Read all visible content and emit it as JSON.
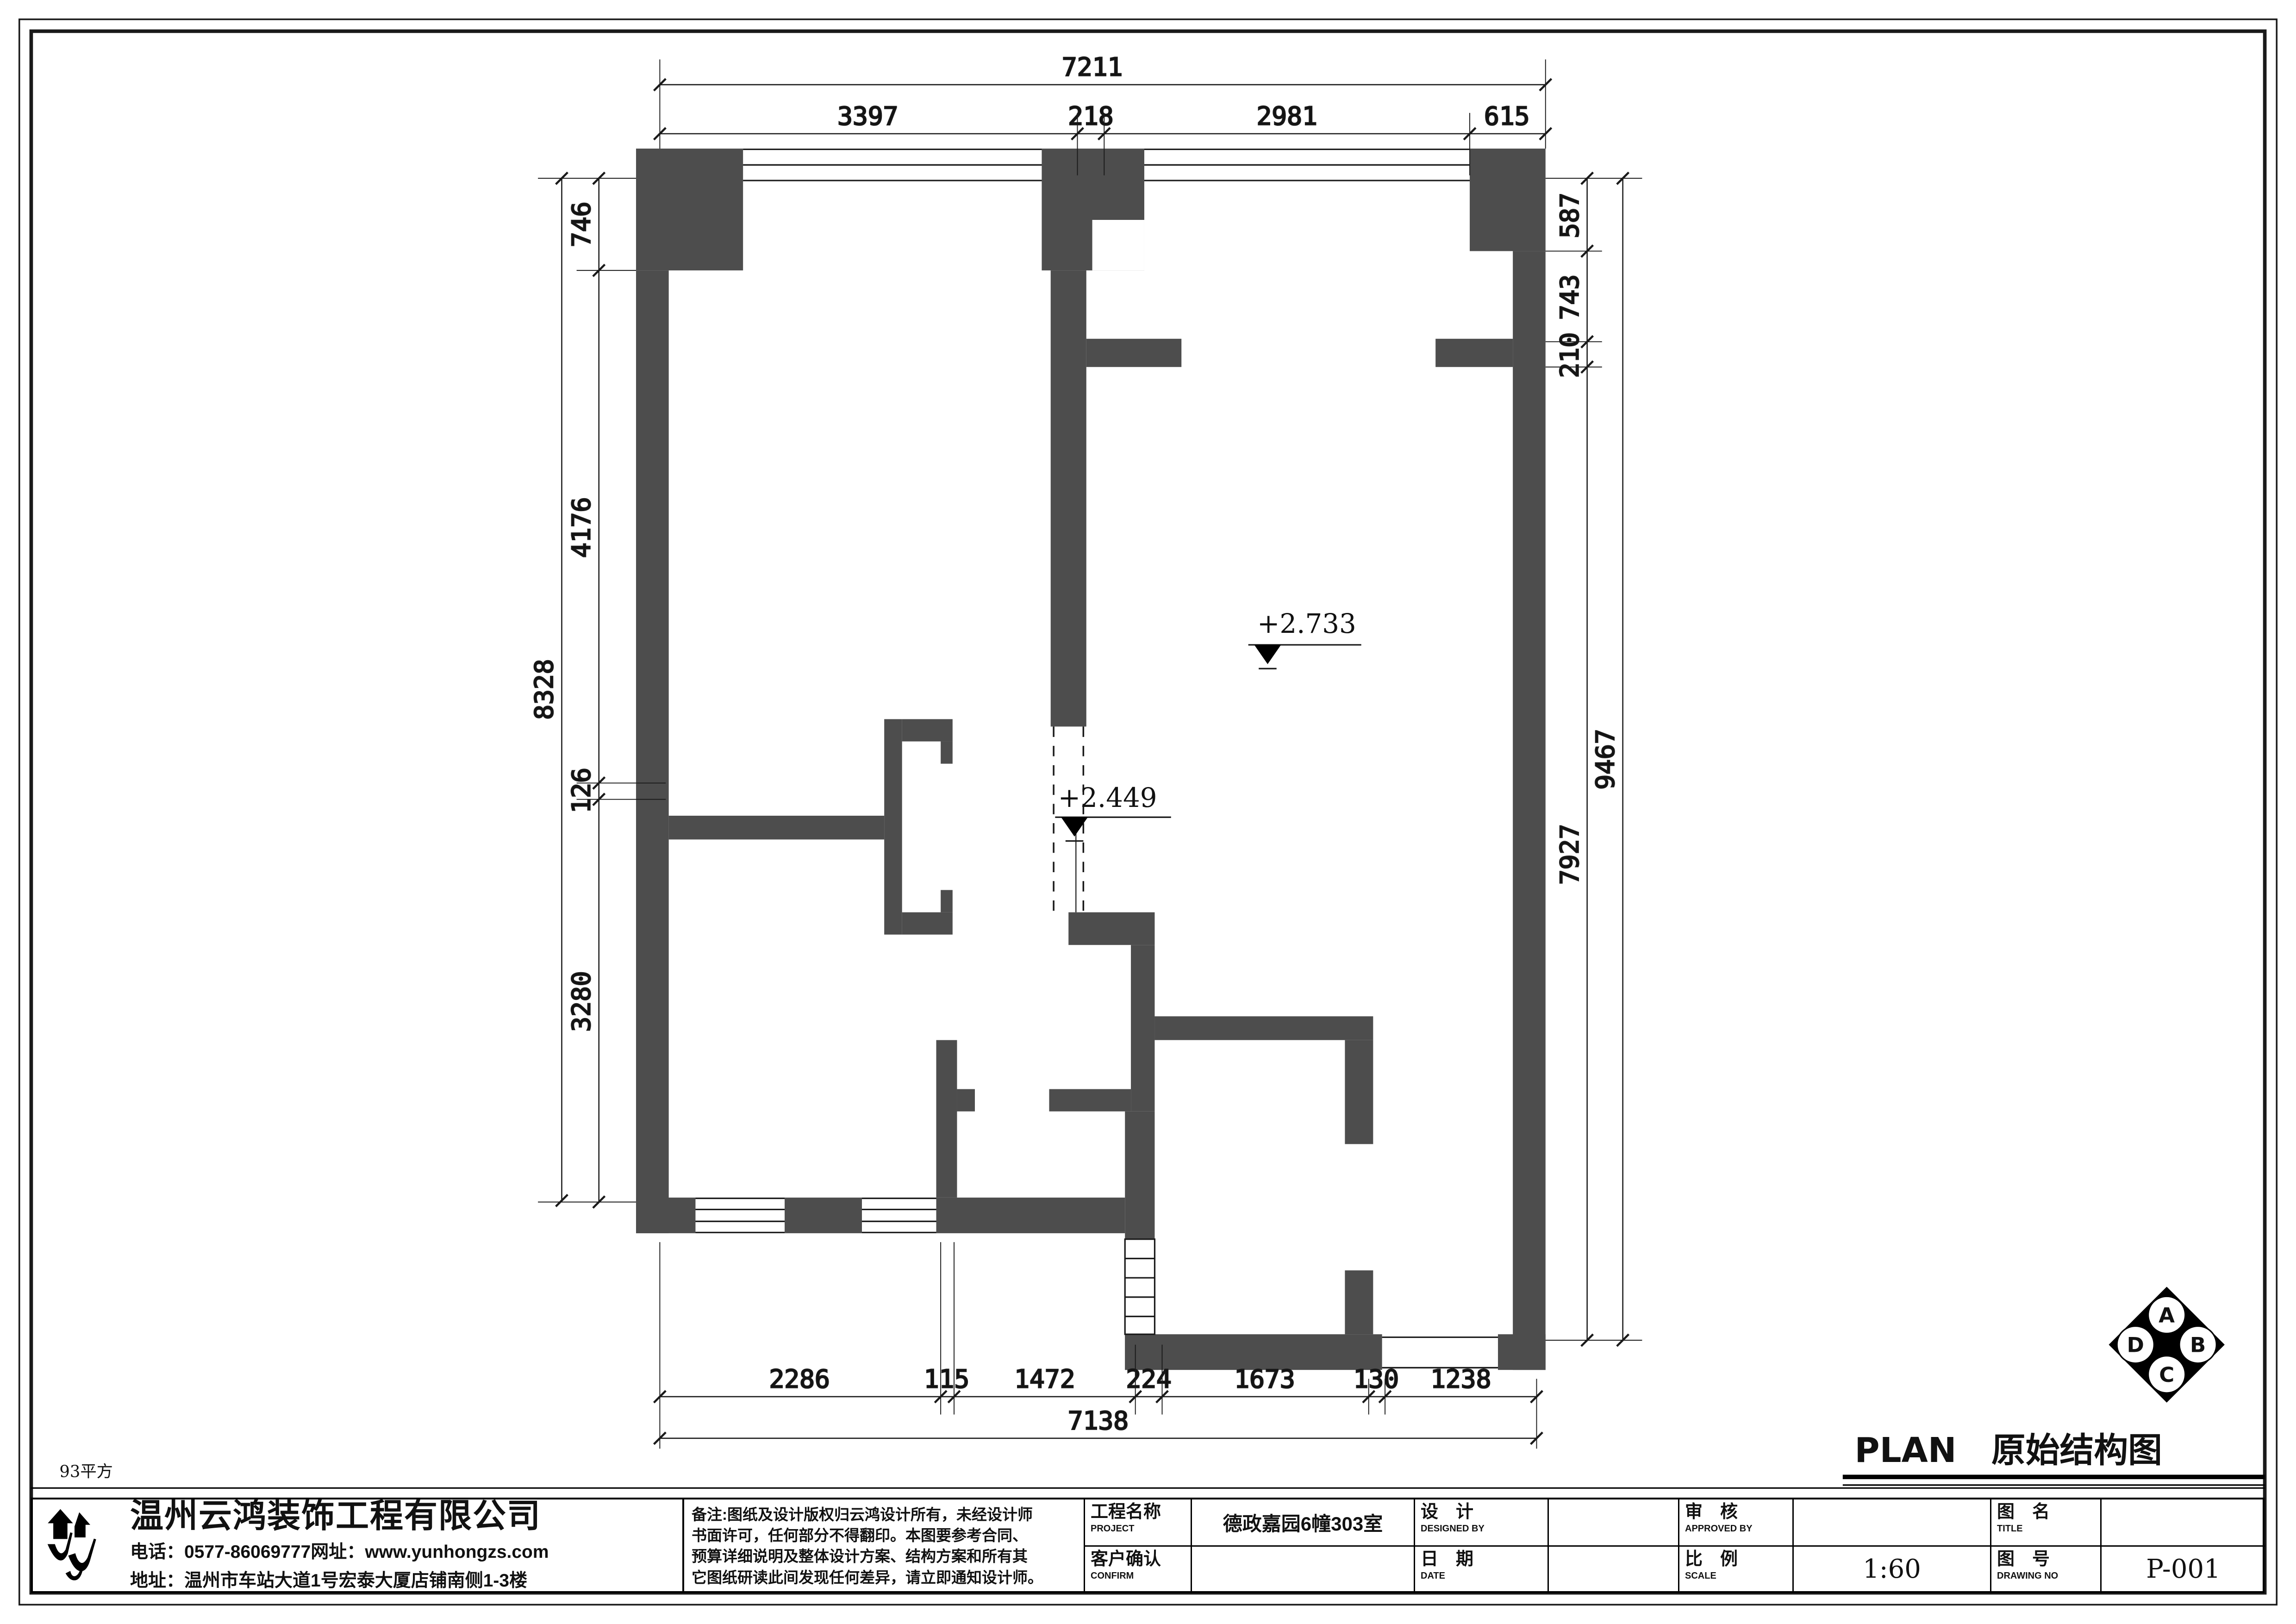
{
  "colors": {
    "wall": "#4d4d4d",
    "line": "#1a1a1a",
    "paper": "#ffffff"
  },
  "area_note": "93平方",
  "plan_title": {
    "en": "PLAN",
    "zh": "原始结构图"
  },
  "compass": {
    "a": "A",
    "b": "B",
    "c": "C",
    "d": "D"
  },
  "elevations": {
    "upper": "+2.733",
    "lower": "+2.449"
  },
  "dims": {
    "top": {
      "overall": "7211",
      "segments": [
        "3397",
        "218",
        "2981",
        "615"
      ]
    },
    "left": {
      "overall": "8328",
      "segments": [
        "746",
        "4176",
        "126",
        "3280"
      ]
    },
    "right": {
      "overall": "9467",
      "segments": [
        "587",
        "743",
        "210",
        "7927"
      ]
    },
    "bottom": {
      "overall": "7138",
      "segments": [
        "2286",
        "115",
        "1472",
        "224",
        "1673",
        "130",
        "1238"
      ]
    }
  },
  "company": {
    "name": "温州云鸿装饰工程有限公司",
    "phone_label": "电话：",
    "phone": "0577-86069777",
    "web_label": "网址：",
    "website": "www.yunhongzs.com",
    "address_label": "地址：",
    "address": "温州市车站大道1号宏泰大厦店铺南侧1-3楼"
  },
  "notes": {
    "line1": "备注:图纸及设计版权归云鸿设计所有，未经设计师",
    "line2": "书面许可，任何部分不得翻印。本图要参考合同、",
    "line3": "预算详细说明及整体设计方案、结构方案和所有其",
    "line4": "它图纸研读此间发现任何差异，请立即通知设计师。"
  },
  "titleblock": {
    "project_label_zh": "工程名称",
    "project_label_en": "PROJECT",
    "project_value": "德政嘉园6幢303室",
    "designed_label_zh": "设　计",
    "designed_label_en": "DESIGNED BY",
    "designed_value": "",
    "confirm_label_zh": "客户确认",
    "confirm_label_en": "CONFIRM",
    "confirm_value": "",
    "date_label_zh": "日　期",
    "date_label_en": "DATE",
    "date_value": "",
    "approved_label_zh": "审　核",
    "approved_label_en": "APPROVED BY",
    "approved_value": "",
    "scale_label_zh": "比　例",
    "scale_label_en": "SCALE",
    "scale_value": "1:60",
    "title_label_zh": "图　名",
    "title_label_en": "TITLE",
    "title_value": "",
    "drawing_label_zh": "图　号",
    "drawing_label_en": "DRAWING NO",
    "drawing_value": "P-001"
  }
}
